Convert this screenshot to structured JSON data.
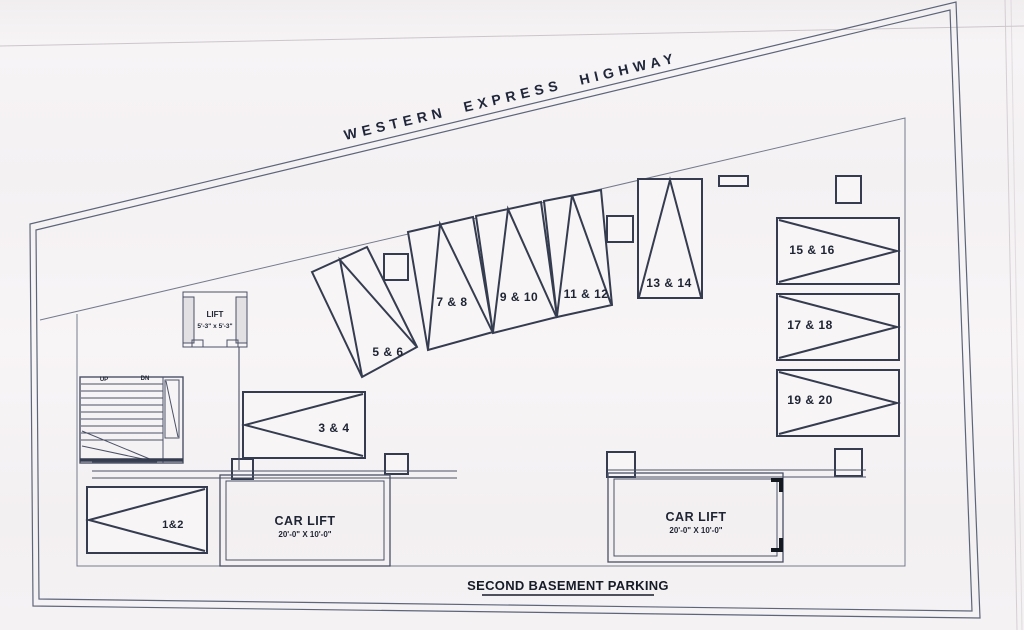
{
  "title": "SECOND BASEMENT PARKING",
  "highway": "WESTERN EXPRESS HIGHWAY",
  "stalls": [
    {
      "label": "1&2"
    },
    {
      "label": "3 & 4"
    },
    {
      "label": "5 & 6"
    },
    {
      "label": "7 & 8"
    },
    {
      "label": "9 & 10"
    },
    {
      "label": "11 & 12"
    },
    {
      "label": "13 & 14"
    },
    {
      "label": "15 & 16"
    },
    {
      "label": "17 & 18"
    },
    {
      "label": "19 & 20"
    }
  ],
  "lift": {
    "label": "LIFT",
    "size": "5'-3\" x 5'-3\""
  },
  "car_lifts": [
    {
      "label": "CAR LIFT",
      "size": "20'-0\" X 10'-0\""
    },
    {
      "label": "CAR LIFT",
      "size": "20'-0\" X 10'-0\""
    }
  ],
  "stairs": {
    "up": "UP",
    "down": "DN"
  },
  "colors": {
    "ink": "#353c4f",
    "boundary": "#5d657a",
    "paper": "#f6f3f5",
    "text": "#1e2433"
  }
}
